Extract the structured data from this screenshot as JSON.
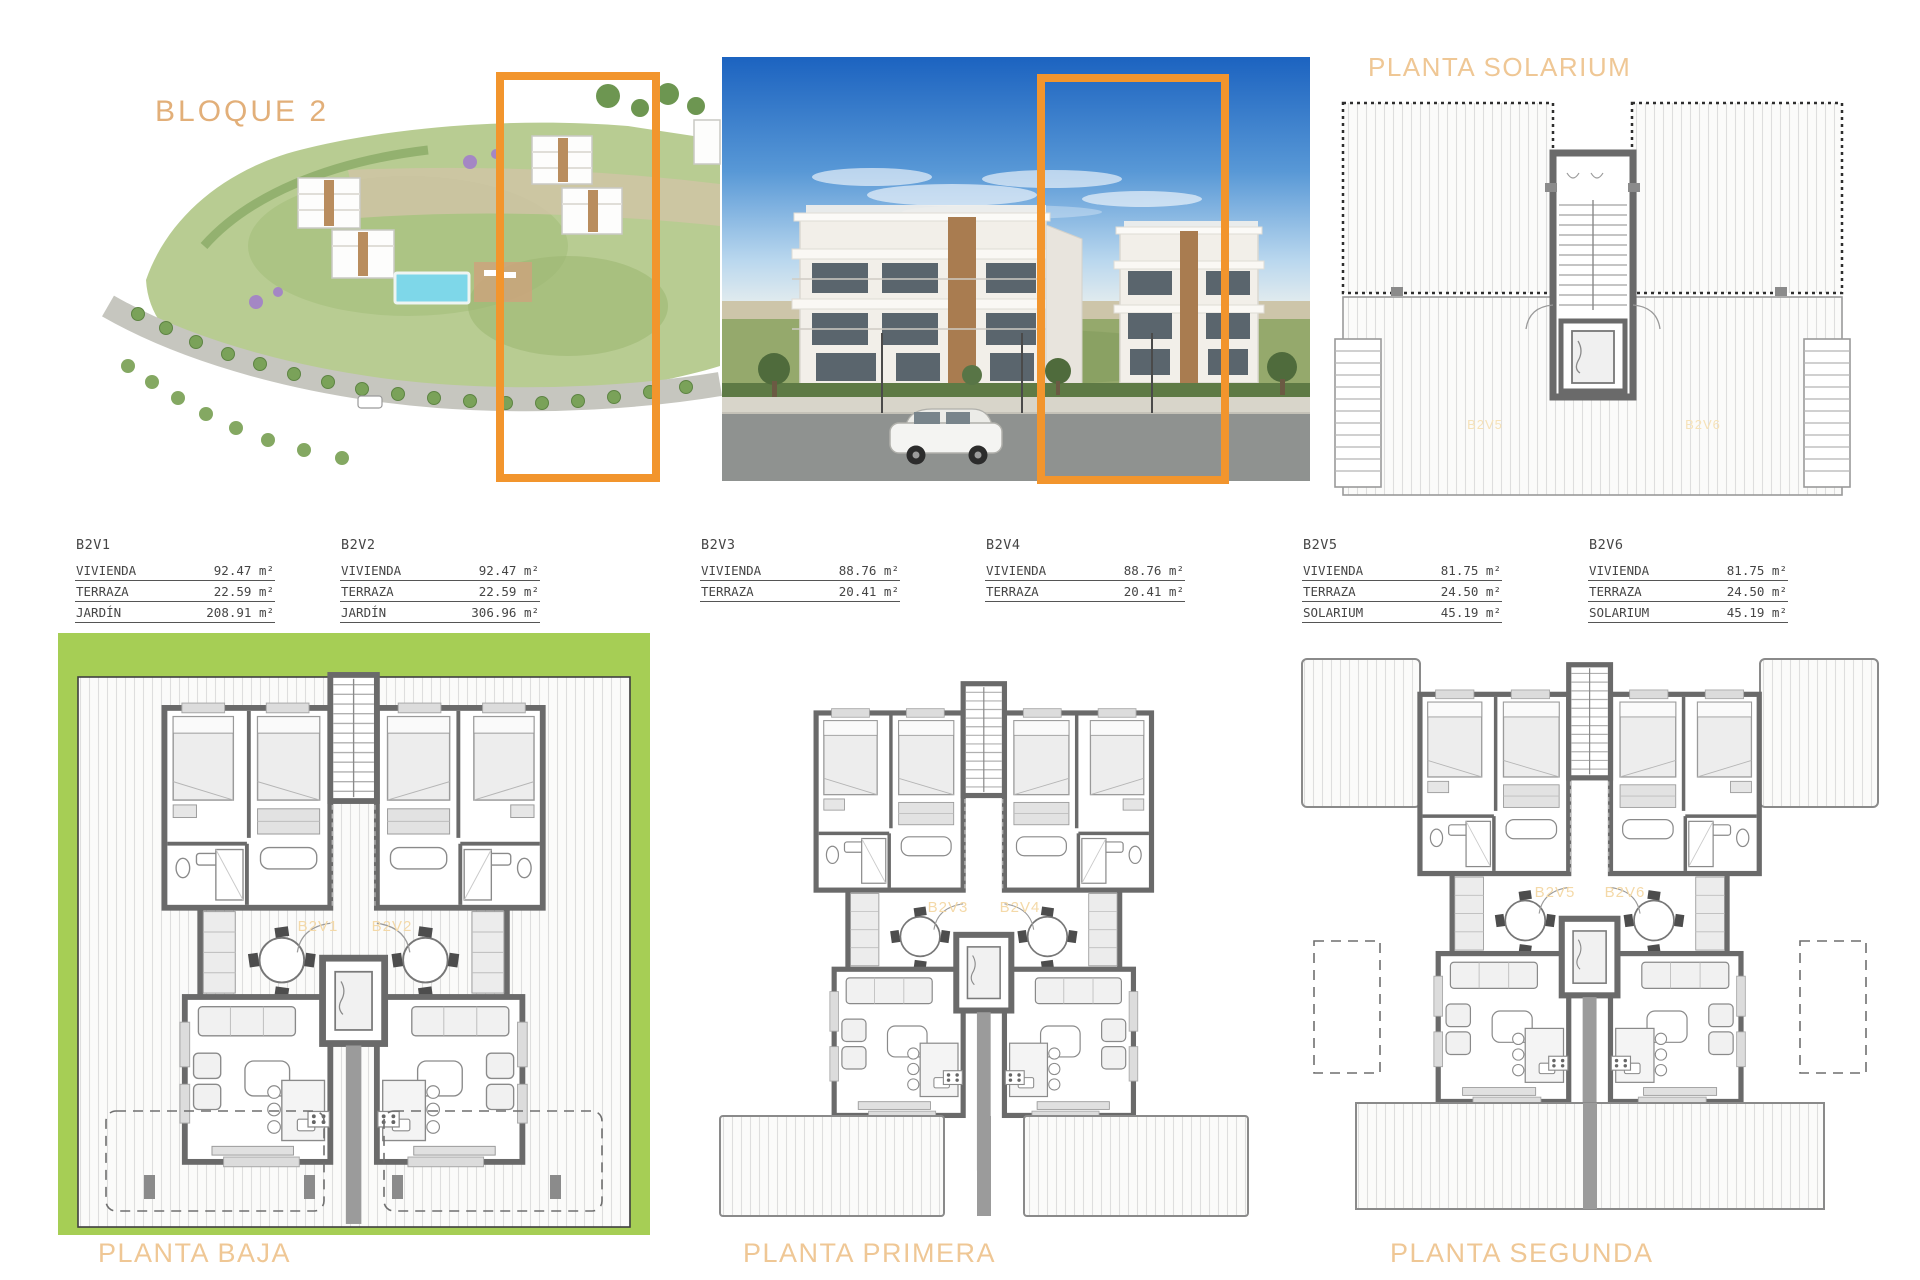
{
  "header": {
    "block_label": "BLOQUE 2",
    "solarium_title": "PLANTA SOLARIUM"
  },
  "colors": {
    "accent_orange": "#F2952D",
    "garden_green": "#A6CE55",
    "title_tan": "#EFC795",
    "block_title_tan": "#E2AF79",
    "plan_wall_gray": "#6A6A6A",
    "pool_blue": "#7ED7E9",
    "sky_blue": "#1C63C0"
  },
  "tables": [
    {
      "unit": "B2V1",
      "rows": [
        {
          "label": "VIVIENDA",
          "value": "92.47 m²"
        },
        {
          "label": "TERRAZA",
          "value": "22.59 m²"
        },
        {
          "label": "JARDÍN",
          "value": "208.91 m²"
        }
      ]
    },
    {
      "unit": "B2V2",
      "rows": [
        {
          "label": "VIVIENDA",
          "value": "92.47 m²"
        },
        {
          "label": "TERRAZA",
          "value": "22.59 m²"
        },
        {
          "label": "JARDÍN",
          "value": "306.96 m²"
        }
      ]
    },
    {
      "unit": "B2V3",
      "rows": [
        {
          "label": "VIVIENDA",
          "value": "88.76 m²"
        },
        {
          "label": "TERRAZA",
          "value": "20.41 m²"
        }
      ]
    },
    {
      "unit": "B2V4",
      "rows": [
        {
          "label": "VIVIENDA",
          "value": "88.76 m²"
        },
        {
          "label": "TERRAZA",
          "value": "20.41 m²"
        }
      ]
    },
    {
      "unit": "B2V5",
      "rows": [
        {
          "label": "VIVIENDA",
          "value": "81.75 m²"
        },
        {
          "label": "TERRAZA",
          "value": "24.50 m²"
        },
        {
          "label": "SOLARIUM",
          "value": "45.19 m²"
        }
      ]
    },
    {
      "unit": "B2V6",
      "rows": [
        {
          "label": "VIVIENDA",
          "value": "81.75 m²"
        },
        {
          "label": "TERRAZA",
          "value": "24.50 m²"
        },
        {
          "label": "SOLARIUM",
          "value": "45.19 m²"
        }
      ]
    }
  ],
  "plans": {
    "baja": {
      "title": "PLANTA BAJA",
      "left_unit": "B2V1",
      "right_unit": "B2V2"
    },
    "primera": {
      "title": "PLANTA PRIMERA",
      "left_unit": "B2V3",
      "right_unit": "B2V4"
    },
    "segunda": {
      "title": "PLANTA SEGUNDA",
      "left_unit": "B2V5",
      "right_unit": "B2V6"
    },
    "solarium": {
      "left_unit": "B2V5",
      "right_unit": "B2V6"
    }
  }
}
